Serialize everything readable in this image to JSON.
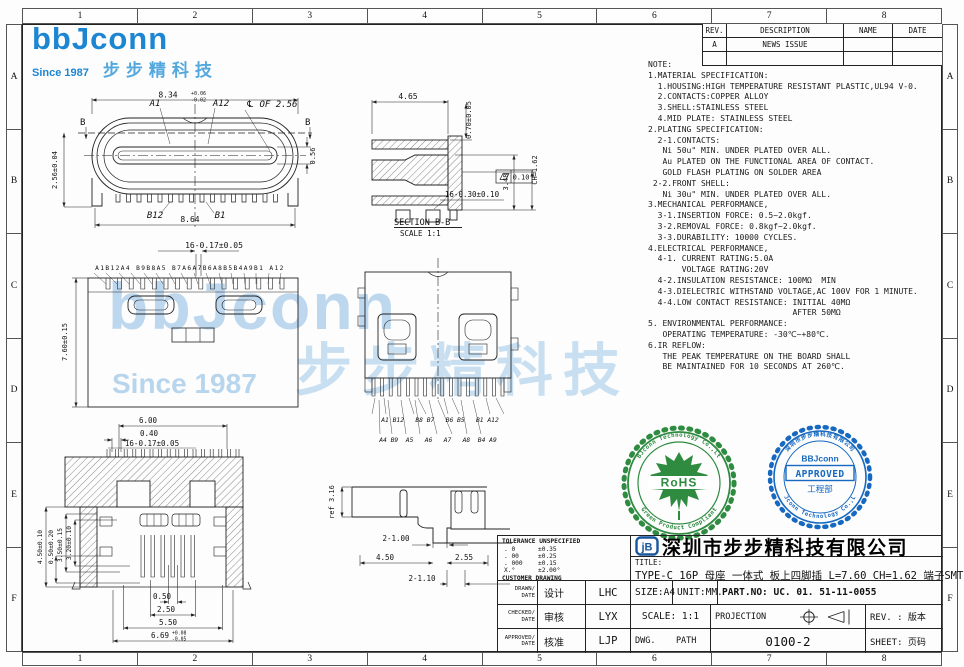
{
  "frame": {
    "cols": [
      "1",
      "2",
      "3",
      "4",
      "5",
      "6",
      "7",
      "8"
    ],
    "rows": [
      "A",
      "B",
      "C",
      "D",
      "E",
      "F"
    ]
  },
  "logo": {
    "brand": "bbJconn",
    "since": "Since 1987",
    "cn": "步步精科技"
  },
  "revision_table": {
    "headers": [
      "REV.",
      "DESCRIPTION",
      "NAME",
      "DATE"
    ],
    "rows": [
      {
        "rev": "A",
        "description": "NEWS ISSUE",
        "name": "",
        "date": ""
      }
    ]
  },
  "notes": "NOTE:\n1.MATERIAL SPECIFICATION:\n  1.HOUSING:HIGH TEMPERATURE RESISTANT PLASTIC,UL94 V-0.\n  2.CONTACTS:COPPER ALLOY\n  3.SHELL:STAINLESS STEEL\n  4.MID PLATE: STAINLESS STEEL\n2.PLATING SPECIFICATION:\n  2-1.CONTACTS:\n   Ni 50u\" MIN. UNDER PLATED OVER ALL.\n   Au PLATED ON THE FUNCTIONAL AREA OF CONTACT.\n   GOLD FLASH PLATING ON SOLDER AREA\n 2-2.FRONT SHELL:\n   Ni 30u\" MIN. UNDER PLATED OVER ALL.\n3.MECHANICAL PERFORMANCE,\n  3-1.INSERTION FORCE: 0.5~2.0kgf.\n  3-2.REMOVAL FORCE: 0.8kgf~2.0kgf.\n  3-3.DURABILITY: 10000 CYCLES.\n4.ELECTRICAL PERFORMANCE,\n  4-1. CURRENT RATING:5.0A\n       VOLTAGE RATING:20V\n  4-2.INSULATION RESISTANCE: 100MΩ  MIN\n  4-3.DIELECTRIC WITHSTAND VOLTAGE,AC 100V FOR 1 MINUTE.\n  4-4.LOW CONTACT RESISTANCE: INITIAL 40MΩ\n                              AFTER 50MΩ\n5. ENVIRONMENTAL PERFORMANCE:\n   OPERATING TEMPERATURE: -30℃~+80℃.\n6.IR REFLOW:\n   THE PEAK TEMPERATURE ON THE BOARD SHALL\n   BE MAINTAINED FOR 10 SECONDS AT 260℃.",
  "seals": {
    "rohs": {
      "label": "RoHS",
      "ring_top": "BBJconn Technology Co.,Ltd",
      "ring_bottom": "Green Product Compliant",
      "color": "#2e8b40"
    },
    "approved": {
      "brand": "BBJconn",
      "label": "APPROVED",
      "dept": "工程部",
      "ring_top": "深圳市步步精科技有限公司",
      "ring_bottom": "BBJconn Technology Co.,Ltd",
      "color": "#1668c0"
    }
  },
  "title_block": {
    "company": "深圳市步步精科技有限公司",
    "title_label": "TITLE:",
    "title": "TYPE-C 16P 母座 一体式 板上四脚插 L=7.60 CH=1.62 端子SMT 带中夹片",
    "tolerance": {
      "header": "TOLERANCE UNSPECIFIED",
      "rows": [
        [
          ". 0",
          "±0.35"
        ],
        [
          ". 00",
          "±0.25"
        ],
        [
          ". 000",
          "±0.15"
        ],
        [
          "X.°",
          "±2.00°"
        ]
      ],
      "footer": "CUSTOMER DRAWING"
    },
    "sign_rows": [
      {
        "en": "DRAWN/\nDATE",
        "cn": "设计",
        "val": "LHC"
      },
      {
        "en": "CHECKED/\nDATE",
        "cn": "审核",
        "val": "LYX"
      },
      {
        "en": "APPROVED/\nDATE",
        "cn": "核准",
        "val": "LJP"
      }
    ],
    "size": "SIZE:A4",
    "unit": "UNIT:MM.",
    "part_no": "PART.NO: UC. 01. 51-11-0055",
    "scale": "SCALE: 1:1",
    "projection_label": "PROJECTION",
    "rev_label": "REV. : 版本",
    "dwg_label": "DWG.    PATH",
    "dwg_no": "0100-2",
    "sheet_label": "SHEET: 页码"
  },
  "views": {
    "front": {
      "d_width_top": "8.34",
      "d_width_top_tp": "+0.06",
      "d_width_top_tm": "-0.02",
      "pin_a1": "A1",
      "pin_a12": "A12",
      "centerline_label": "℄ OF 2.56",
      "section_b_left": "B",
      "section_b_right": "B",
      "d_height_left": "2.56±0.04",
      "d_tongue": "0.56",
      "pin_b12": "B12",
      "pin_b1": "B1",
      "d_width_bottom": "8.64"
    },
    "section": {
      "d_top": "4.65",
      "d_070": "0.70±0.05",
      "d_ch": "CH=1.62",
      "d_348": "3.48",
      "flatness": "0.10",
      "d_pins": "16-0.30±0.10",
      "label": "SECTION B-B",
      "scale": "SCALE 1:1"
    },
    "top": {
      "d_pitch": "16-0.17±0.05",
      "pin_row": "A1B12A4 B9B8A5 B7A6A7B6A8B5B4A9B1 A12",
      "d_height": "7.60±0.15"
    },
    "mid": {
      "pin_row_upper": "A1 B12   B8 B7   B6 B5   B1 A12",
      "pin_row_lower": "A4 B9  A5   A6   A7   A8  B4 A9"
    },
    "bottom": {
      "d_600": "6.00",
      "d_040": "0.40",
      "d_pitch": "16-0.17±0.05",
      "d_450": "4.50±0.10",
      "d_050": "0.50±0.20",
      "d_350": "3.50±0.15",
      "d_320": "3.20±0.10",
      "b_050": "0.50",
      "b_250": "2.50",
      "b_550": "5.50",
      "b_669": "6.69",
      "b_669_tp": "+0.08",
      "b_669_tm": "-0.05"
    },
    "side": {
      "d_ref": "ref 3.16",
      "d_2x100": "2-1.00",
      "d_450": "4.50",
      "d_255": "2.55",
      "d_2x110": "2-1.10"
    }
  }
}
